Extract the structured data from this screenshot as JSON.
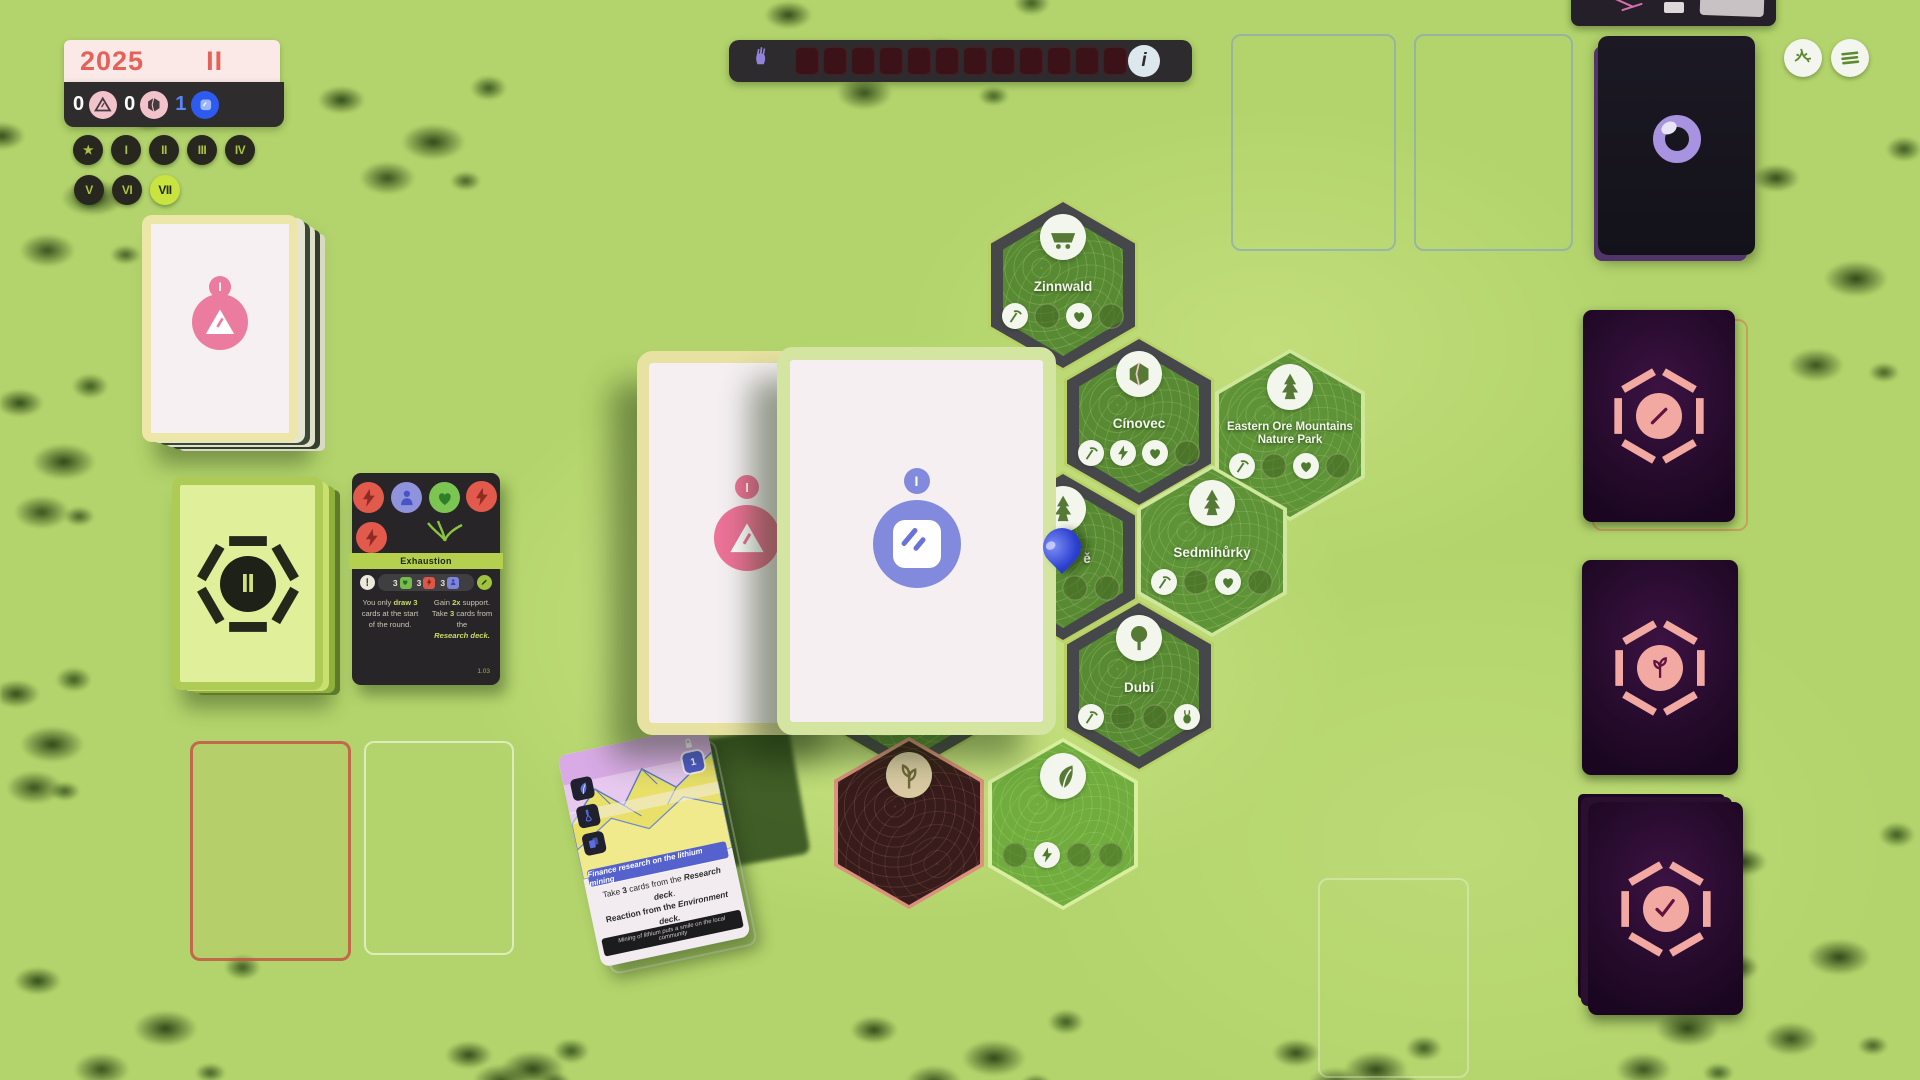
{
  "hud": {
    "year": "2025",
    "round": "II",
    "counters": [
      {
        "value": "0",
        "icon": "triangle"
      },
      {
        "value": "0",
        "icon": "crystal"
      },
      {
        "value": "1",
        "icon": "square"
      }
    ],
    "chips_row1": [
      "★",
      "I",
      "II",
      "III",
      "IV"
    ],
    "chips_row2": [
      "V",
      "VI",
      "VII"
    ],
    "active_chip": "VII"
  },
  "support_track": {
    "icon": "fist",
    "segments": 12,
    "info_label": "i"
  },
  "top_right_buttons": [
    {
      "icon": "branches"
    },
    {
      "icon": "menu"
    }
  ],
  "decks": {
    "event_deck": {
      "badge": "I",
      "icon": "triangle"
    },
    "phase_deck": {
      "numeral": "II"
    },
    "observe_deck": {
      "icon": "lens"
    }
  },
  "exhaustion_card": {
    "title": "Exhaustion",
    "tokens": [
      "bolt",
      "person",
      "heart",
      "bolt",
      "bolt"
    ],
    "cost_prefix_icon": "exclaim",
    "cost": [
      {
        "count": "3",
        "icon": "heart"
      },
      {
        "count": "3",
        "icon": "bolt"
      },
      {
        "count": "3",
        "icon": "person"
      }
    ],
    "cost_suffix_icon": "pencil",
    "left": [
      "You only ",
      "draw 3",
      " cards at the start of the round."
    ],
    "right1": [
      "Gain ",
      "2x",
      " support."
    ],
    "right2": [
      "Take ",
      "3",
      " cards from the "
    ],
    "right3": "Research deck.",
    "code": "1.03"
  },
  "hand": {
    "back_card": {
      "badge": "I",
      "icon": "triangle"
    },
    "active_card": {
      "badge": "I"
    }
  },
  "map": {
    "hexes": [
      {
        "name": "Zinnwald",
        "icon": "cart",
        "slots": [
          "pickaxe",
          "faded",
          "heart",
          "faded"
        ]
      },
      {
        "name": "Cínovec",
        "icon": "crystal",
        "slots": [
          "pickaxe",
          "bolt",
          "heart",
          "faded"
        ]
      },
      {
        "name": "Eastern Ore Mountains Nature Park",
        "icon": "pine",
        "slots": [
          "pickaxe",
          "faded",
          "heart",
          "faded"
        ]
      },
      {
        "name": "ě",
        "icon": "pine",
        "slots": [
          "faded",
          "faded"
        ]
      },
      {
        "name": "Sedmihůrky",
        "icon": "pine",
        "slots": [
          "pickaxe",
          "faded",
          "heart",
          "faded"
        ]
      },
      {
        "name": "Dubí",
        "icon": "oak",
        "slots": [
          "pickaxe",
          "faded",
          "faded",
          "rabbit"
        ]
      },
      {
        "name": "",
        "icon": "",
        "slots": []
      },
      {
        "name": "",
        "icon": "plant",
        "slots": []
      },
      {
        "name": "",
        "icon": "leaf",
        "slots": [
          "faded",
          "bolt",
          "faded",
          "faded"
        ]
      }
    ]
  },
  "research_card": {
    "banner": "Finance research on the lithium mining",
    "line1a": "Take ",
    "line1b": "3",
    "line1c": " cards from the ",
    "line1d": "Research deck",
    "line1e": ".",
    "line2a": "Reaction from the ",
    "line2b": "Environment deck.",
    "flavor": "Mining of lithium puts a smile on the local community",
    "cost_icons": [
      "leaf",
      "flask",
      "cards"
    ],
    "lock_count": "1"
  },
  "action_cards": [
    {
      "icon": "slash"
    },
    {
      "icon": "sprout"
    },
    {
      "icon": "check"
    }
  ]
}
